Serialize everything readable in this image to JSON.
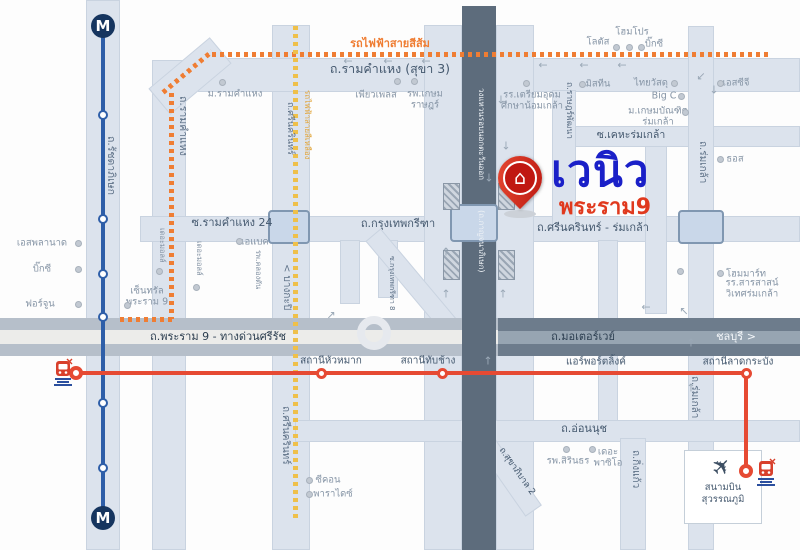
{
  "logo": {
    "brand": "เวนิว",
    "sub": "พระราม9"
  },
  "airport": {
    "line1": "สนามบิน",
    "line2": "สุวรรณภูมิ"
  },
  "colors": {
    "brand_blue": "#1a20c8",
    "brand_red": "#e0391e",
    "mrt_blue": "#2e5ea8",
    "orange_line": "#ef7d33",
    "yellow_line": "#efc04a",
    "arl_red": "#e64a33",
    "ring_road": "#5d6c7c",
    "road_fill": "#dce3ed"
  },
  "roads": [
    {
      "n": "ratchadaphisek-band",
      "x": 86,
      "y": 0,
      "w": 34,
      "h": 550
    },
    {
      "n": "ramkhamhaeng-band-vertical",
      "x": 152,
      "y": 60,
      "w": 34,
      "h": 490
    },
    {
      "n": "srinakarin-band",
      "x": 272,
      "y": 25,
      "w": 38,
      "h": 525
    },
    {
      "n": "ramkhamhaeng-band-horizontal",
      "x": 198,
      "y": 58,
      "w": 602,
      "h": 34
    },
    {
      "n": "ramkhamhaeng-bend",
      "x": 150,
      "y": 59,
      "w": 80,
      "h": 34,
      "rot": -40
    },
    {
      "n": "krungthep-kreetha-corridor",
      "x": 140,
      "y": 216,
      "w": 660,
      "h": 26
    },
    {
      "n": "kehha-romklao-road",
      "x": 552,
      "y": 126,
      "w": 248,
      "h": 21
    },
    {
      "n": "rat-phatthana-road",
      "x": 552,
      "y": 90,
      "w": 24,
      "h": 140
    },
    {
      "n": "romklao-road",
      "x": 688,
      "y": 26,
      "w": 26,
      "h": 524
    },
    {
      "n": "ring-frontage-west",
      "x": 424,
      "y": 25,
      "w": 38,
      "h": 525
    },
    {
      "n": "ring-frontage-east",
      "x": 496,
      "y": 25,
      "w": 38,
      "h": 525
    },
    {
      "n": "sarasas-soi",
      "x": 645,
      "y": 146,
      "w": 22,
      "h": 168
    },
    {
      "n": "soi-south-mid",
      "x": 598,
      "y": 240,
      "w": 20,
      "h": 185
    },
    {
      "n": "kreetha-soi-a",
      "x": 340,
      "y": 240,
      "w": 20,
      "h": 64
    },
    {
      "n": "kreetha-soi-b",
      "x": 378,
      "y": 240,
      "w": 20,
      "h": 58
    },
    {
      "n": "kreetha-diagonal",
      "x": 352,
      "y": 270,
      "w": 118,
      "h": 20,
      "rot": 50
    },
    {
      "n": "onnut-road",
      "x": 295,
      "y": 420,
      "w": 505,
      "h": 22
    },
    {
      "n": "kingkaew-road",
      "x": 620,
      "y": 438,
      "w": 26,
      "h": 112
    },
    {
      "n": "sukhapiban2-curve",
      "x": 455,
      "y": 460,
      "w": 100,
      "h": 20,
      "rot": 55
    },
    {
      "n": "rama9-north-strip",
      "x": 0,
      "y": 318,
      "w": 505,
      "h": 12,
      "cls": "gray"
    },
    {
      "n": "rama9-center",
      "x": 0,
      "y": 330,
      "w": 505,
      "h": 14,
      "cls": "hwc"
    },
    {
      "n": "rama9-south-strip",
      "x": 0,
      "y": 344,
      "w": 505,
      "h": 12,
      "cls": "gray"
    },
    {
      "n": "motorway-band",
      "x": 498,
      "y": 318,
      "w": 302,
      "h": 38,
      "cls": "mw"
    },
    {
      "n": "motorway-stripe",
      "x": 498,
      "y": 331,
      "w": 302,
      "h": 13,
      "cls": "mws"
    },
    {
      "n": "ring-road-dark",
      "x": 462,
      "y": 6,
      "w": 34,
      "h": 544,
      "cls": "ring"
    },
    {
      "n": "bridge-soi24",
      "x": 268,
      "y": 210,
      "w": 42,
      "h": 34,
      "cls": "ibox"
    },
    {
      "n": "bridge-ring-crossing",
      "x": 450,
      "y": 204,
      "w": 48,
      "h": 38,
      "cls": "ibox"
    },
    {
      "n": "bridge-romklao",
      "x": 678,
      "y": 210,
      "w": 46,
      "h": 34,
      "cls": "ibox"
    },
    {
      "n": "overpass-pad",
      "x": 443,
      "y": 183,
      "w": 17,
      "h": 27,
      "cls": "pad"
    },
    {
      "n": "overpass-pad",
      "x": 498,
      "y": 183,
      "w": 17,
      "h": 27,
      "cls": "pad"
    },
    {
      "n": "overpass-pad",
      "x": 443,
      "y": 250,
      "w": 17,
      "h": 30,
      "cls": "pad"
    },
    {
      "n": "overpass-pad",
      "x": 498,
      "y": 250,
      "w": 17,
      "h": 30,
      "cls": "pad"
    },
    {
      "n": "u-turn-loop",
      "x": 357,
      "y": 316,
      "w": 34,
      "h": 34,
      "cls": "uturn"
    }
  ],
  "road_labels": [
    {
      "t": "รถไฟฟ้าสายสีส้ม",
      "x": 390,
      "y": 44,
      "cls": "or",
      "fs": 11
    },
    {
      "t": "ถ.รามคำแหง (สุขา 3)",
      "x": 390,
      "y": 69,
      "fs": 12.5
    },
    {
      "t": "ซ.รามคำแหง 24",
      "x": 232,
      "y": 223,
      "fs": 11
    },
    {
      "t": "ถ.กรุงเทพกรีฑา",
      "x": 398,
      "y": 224,
      "fs": 11
    },
    {
      "t": "ถ.ศรีนครินทร์ - ร่มเกล้า",
      "x": 593,
      "y": 228,
      "fs": 11
    },
    {
      "t": "ซ.เคหะร่มเกล้า",
      "x": 631,
      "y": 136,
      "fs": 10.5
    },
    {
      "t": "ถ.พระราม 9 - ทางด่วนศรีรัช",
      "x": 218,
      "y": 337,
      "fs": 11,
      "cls": "dk"
    },
    {
      "t": "ถ.มอเตอร์เวย์",
      "x": 583,
      "y": 337,
      "fs": 11,
      "cls": "dk"
    },
    {
      "t": "ชลบุรี >",
      "x": 736,
      "y": 337,
      "fs": 11,
      "cls": "wt"
    },
    {
      "t": "ถ.อ่อนนุช",
      "x": 584,
      "y": 429,
      "fs": 11
    },
    {
      "t": "สถานีหัวหมาก",
      "x": 331,
      "y": 361,
      "fs": 10
    },
    {
      "t": "สถานีทับช้าง",
      "x": 428,
      "y": 361,
      "fs": 10
    },
    {
      "t": "แอร์พอร์ตลิ้งค์",
      "x": 596,
      "y": 362,
      "fs": 10
    },
    {
      "t": "สถานีลาดกระบัง",
      "x": 738,
      "y": 362,
      "fs": 10
    },
    {
      "t": "ถ.สุขาภิบาล 2",
      "x": 516,
      "y": 472,
      "fs": 9,
      "rot": 55
    }
  ],
  "vert_labels": [
    {
      "t": "ถ.รัชดาภิเษก",
      "x": 116,
      "y": 136,
      "fs": 10.5
    },
    {
      "t": "ถ.รามคำแหง",
      "x": 188,
      "y": 96,
      "fs": 10.5
    },
    {
      "t": "ถ.ศรีนครินทร์",
      "x": 294,
      "y": 102,
      "fs": 9
    },
    {
      "t": "รถไฟฟ้าสายสีเหลือง",
      "x": 311,
      "y": 90,
      "fs": 8,
      "cls": "yl"
    },
    {
      "t": "< บางกะปิ",
      "x": 291,
      "y": 264,
      "fs": 10
    },
    {
      "t": "ถ.ราษฎร์พัฒนา",
      "x": 573,
      "y": 82,
      "fs": 8.5
    },
    {
      "t": "วงแหวนรอบนอกตะวันออก",
      "x": 485,
      "y": 88,
      "fs": 8,
      "cls": "wt"
    },
    {
      "t": "(ถ.กาญจนาภิเษก)",
      "x": 485,
      "y": 210,
      "fs": 8,
      "cls": "wt"
    },
    {
      "t": "ถ.ร่มเกล้า",
      "x": 707,
      "y": 141,
      "fs": 10
    },
    {
      "t": "ถ.ร่มเกล้า",
      "x": 699,
      "y": 376,
      "fs": 10
    },
    {
      "t": "ถ.ศรีนครินทร์",
      "x": 290,
      "y": 406,
      "fs": 10
    },
    {
      "t": "ถ.กิ่งแก้ว",
      "x": 640,
      "y": 450,
      "fs": 10
    },
    {
      "t": "ซ.กรุงเทพกรีฑา 8",
      "x": 395,
      "y": 256,
      "fs": 7
    },
    {
      "t": "เดอะมอลล์",
      "x": 166,
      "y": 228,
      "fs": 7.5,
      "cls": "poi-c"
    },
    {
      "t": "เดอะมอลล์",
      "x": 203,
      "y": 241,
      "fs": 7.5,
      "cls": "poi-c"
    },
    {
      "t": "รพ.คลองตัน",
      "x": 262,
      "y": 250,
      "fs": 7.5,
      "cls": "poi-c"
    }
  ],
  "pois": [
    {
      "t": "ม.รามคำแหง",
      "x": 235,
      "y": 94,
      "dx": 222,
      "dy": 82
    },
    {
      "t": "เพียวเพลส",
      "x": 376,
      "y": 95,
      "dx": 397,
      "dy": 81
    },
    {
      "t": "รพ.เกษม\nราษฎร์",
      "x": 425,
      "y": 100,
      "dx": 414,
      "dy": 81
    },
    {
      "t": "รร.เตรียมอุดม\nศึกษาน้อมเกล้า",
      "x": 532,
      "y": 101,
      "dx": 526,
      "dy": 83
    },
    {
      "t": "มิสทีน",
      "x": 598,
      "y": 84,
      "dx": 582,
      "dy": 84
    },
    {
      "t": "ไทยวัสดุ",
      "x": 651,
      "y": 83,
      "dx": 674,
      "dy": 83
    },
    {
      "t": "Big C",
      "x": 664,
      "y": 96,
      "dx": 681,
      "dy": 96
    },
    {
      "t": "ม.เกษมบัณฑิต\nร่มเกล้า",
      "x": 658,
      "y": 117,
      "dx": 685,
      "dy": 112
    },
    {
      "t": "เอสซีจี",
      "x": 736,
      "y": 83,
      "dx": 720,
      "dy": 83
    },
    {
      "t": "โฮมโปร",
      "x": 632,
      "y": 32
    },
    {
      "t": "โลตัส",
      "x": 598,
      "y": 42
    },
    {
      "t": "บิ๊กซี",
      "x": 654,
      "y": 44
    },
    {
      "t": "ธอส",
      "x": 735,
      "y": 159,
      "dx": 720,
      "dy": 159
    },
    {
      "t": "โฮมมาร์ท",
      "x": 746,
      "y": 274,
      "dx": 720,
      "dy": 273
    },
    {
      "t": "รร.สารสาสน์\nวิเทศร่มเกล้า",
      "x": 752,
      "y": 289,
      "dx": 680,
      "dy": 271
    },
    {
      "t": "เอสพลานาด",
      "x": 42,
      "y": 243,
      "dx": 78,
      "dy": 243
    },
    {
      "t": "บิ๊กซี",
      "x": 42,
      "y": 269,
      "dx": 78,
      "dy": 269
    },
    {
      "t": "ฟอร์จูน",
      "x": 40,
      "y": 304,
      "dx": 78,
      "dy": 304
    },
    {
      "t": "เซ็นทรัล\nพระราม 9",
      "x": 147,
      "y": 297,
      "dx": 127,
      "dy": 305
    },
    {
      "t": "เอแบค",
      "x": 255,
      "y": 242,
      "dx": 239,
      "dy": 241
    },
    {
      "t": "ซีคอน",
      "x": 328,
      "y": 480,
      "dx": 309,
      "dy": 480
    },
    {
      "t": "พาราไดซ์",
      "x": 333,
      "y": 494,
      "dx": 309,
      "dy": 494
    },
    {
      "t": "รพ.สิรินธร",
      "x": 568,
      "y": 461,
      "dx": 566,
      "dy": 449
    },
    {
      "t": "เดอะ\nพาซิโอ",
      "x": 608,
      "y": 458,
      "dx": 592,
      "dy": 449
    }
  ],
  "extra_dots": [
    [
      616,
      47
    ],
    [
      629,
      47
    ],
    [
      641,
      47
    ],
    [
      159,
      271
    ],
    [
      196,
      287
    ]
  ],
  "arrows": [
    [
      "←",
      348,
      61
    ],
    [
      "←",
      388,
      61
    ],
    [
      "←",
      426,
      61
    ],
    [
      "←",
      543,
      65
    ],
    [
      "←",
      584,
      65
    ],
    [
      "←",
      622,
      65
    ],
    [
      "↙",
      701,
      76
    ],
    [
      "↓",
      714,
      90
    ],
    [
      "↓",
      501,
      100
    ],
    [
      "↓",
      506,
      146
    ],
    [
      "↓",
      489,
      178
    ],
    [
      "↘",
      513,
      190
    ],
    [
      "↑",
      446,
      252
    ],
    [
      "↑",
      446,
      294
    ],
    [
      "↑",
      503,
      294
    ],
    [
      "↗",
      331,
      315
    ],
    [
      "↑",
      691,
      343
    ],
    [
      "↑",
      691,
      388
    ],
    [
      "↑",
      488,
      361
    ],
    [
      "←",
      646,
      307
    ],
    [
      "↖",
      684,
      311
    ]
  ],
  "transit": {
    "mrt": {
      "m_label": "M",
      "line": {
        "x": 101,
        "y": 30,
        "h": 490
      },
      "stations_y": [
        115,
        219,
        274,
        317,
        403,
        468
      ],
      "m_badges": [
        [
          91,
          14
        ],
        [
          91,
          506
        ]
      ]
    },
    "orange_line": {
      "segs": [
        {
          "x": 120,
          "y": 317,
          "w": 56
        },
        {
          "x": 169,
          "y": 93,
          "h": 226
        },
        {
          "x": 163,
          "y": 90,
          "w": 64,
          "rot": -40
        },
        {
          "x": 212,
          "y": 52,
          "w": 558
        }
      ]
    },
    "yellow_line": {
      "segs": [
        {
          "x": 293,
          "y": 26,
          "h": 496
        }
      ]
    },
    "arl": {
      "h": {
        "x": 76,
        "y": 371,
        "w": 670
      },
      "v": {
        "x": 744,
        "y": 373,
        "h": 100
      },
      "stations": [
        [
          321,
          373
        ],
        [
          442,
          373
        ],
        [
          746,
          373
        ]
      ],
      "termini": [
        [
          76,
          373
        ],
        [
          746,
          471
        ]
      ]
    }
  }
}
